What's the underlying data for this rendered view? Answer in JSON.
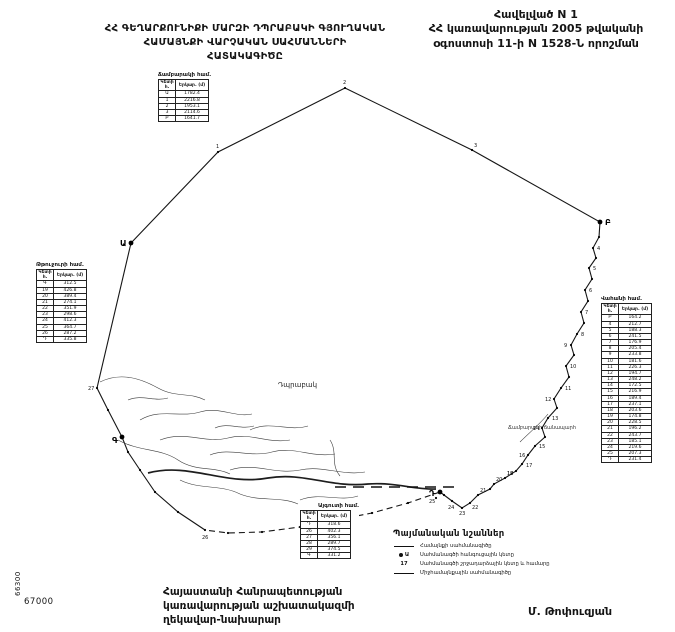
{
  "header": {
    "title_lines": [
      "ՀՀ ԳԵՂԱՐՔՈՒՆԻՔԻ ՄԱՐԶԻ ԴՊՐԱԲԱԿԻ ԳՅՈՒՂԱԿԱՆ",
      "ՀԱՄԱՅՆՔԻ ՎԱՐՉԱԿԱՆ  ՍԱՀՄԱՆՆԵՐԻ",
      "ՀԱՏԱԿԱԳԻԾԸ"
    ],
    "annex_lines": [
      "Հավելված N 1",
      "ՀՀ կառավարության 2005 թվականի",
      "օգոստոսի 11-ի N 1528-Ն որոշման"
    ]
  },
  "map": {
    "settlement_label": "Դպրաբակ",
    "road_label": "Ճամբարակի ճանապարհ",
    "grid_x_label": "67000",
    "grid_y_label": "66300",
    "points": [
      {
        "x": 131,
        "y": 243,
        "label": "Ա",
        "big": true,
        "dx": -11,
        "dy": 3
      },
      {
        "x": 600,
        "y": 222,
        "label": "Բ",
        "big": true,
        "dx": 5,
        "dy": 3
      },
      {
        "x": 122,
        "y": 437,
        "label": "Գ",
        "big": true,
        "dx": -10,
        "dy": 6
      },
      {
        "x": 440,
        "y": 492,
        "label": "Դ",
        "big": true,
        "dx": -11,
        "dy": 4
      },
      {
        "x": 218,
        "y": 152,
        "label": "1",
        "dx": -2,
        "dy": -4
      },
      {
        "x": 345,
        "y": 88,
        "label": "2",
        "dx": -2,
        "dy": -4
      },
      {
        "x": 472,
        "y": 150,
        "label": "3",
        "dx": 2,
        "dy": -3
      },
      {
        "x": 593,
        "y": 248,
        "label": "4",
        "dx": 4,
        "dy": 2
      },
      {
        "x": 589,
        "y": 268,
        "label": "5",
        "dx": 4,
        "dy": 2
      },
      {
        "x": 585,
        "y": 290,
        "label": "6",
        "dx": 4,
        "dy": 2
      },
      {
        "x": 581,
        "y": 312,
        "label": "7",
        "dx": 4,
        "dy": 2
      },
      {
        "x": 577,
        "y": 334,
        "label": "8",
        "dx": 4,
        "dy": 2
      },
      {
        "x": 571,
        "y": 345,
        "label": "9",
        "dx": -7,
        "dy": 2
      },
      {
        "x": 566,
        "y": 366,
        "label": "10",
        "dx": 4,
        "dy": 2
      },
      {
        "x": 561,
        "y": 388,
        "label": "11",
        "dx": 4,
        "dy": 2
      },
      {
        "x": 554,
        "y": 399,
        "label": "12",
        "dx": -9,
        "dy": 2
      },
      {
        "x": 548,
        "y": 418,
        "label": "13",
        "dx": 4,
        "dy": 2
      },
      {
        "x": 542,
        "y": 428,
        "label": "14",
        "dx": -9,
        "dy": 2
      },
      {
        "x": 535,
        "y": 446,
        "label": "15",
        "dx": 4,
        "dy": 2
      },
      {
        "x": 528,
        "y": 455,
        "label": "16",
        "dx": -9,
        "dy": 2
      },
      {
        "x": 522,
        "y": 464,
        "label": "17",
        "dx": 4,
        "dy": 3
      },
      {
        "x": 516,
        "y": 471,
        "label": "18",
        "dx": -9,
        "dy": 4
      },
      {
        "x": 505,
        "y": 478,
        "label": "19",
        "dx": 2,
        "dy": -3
      },
      {
        "x": 494,
        "y": 484,
        "label": "20",
        "dx": 2,
        "dy": -3
      },
      {
        "x": 478,
        "y": 495,
        "label": "21",
        "dx": 2,
        "dy": -3
      },
      {
        "x": 470,
        "y": 503,
        "label": "22",
        "dx": 2,
        "dy": 6
      },
      {
        "x": 462,
        "y": 508,
        "label": "23",
        "dx": -3,
        "dy": 7
      },
      {
        "x": 452,
        "y": 501,
        "label": "24",
        "dx": -4,
        "dy": 8
      },
      {
        "x": 436,
        "y": 498,
        "label": "25",
        "dx": -7,
        "dy": 5
      },
      {
        "x": 205,
        "y": 530,
        "label": "26",
        "dx": -3,
        "dy": 9
      },
      {
        "x": 97,
        "y": 388,
        "label": "27",
        "dx": -9,
        "dy": 2
      },
      {
        "x": 599,
        "y": 237
      },
      {
        "x": 596,
        "y": 258
      },
      {
        "x": 592,
        "y": 279
      },
      {
        "x": 588,
        "y": 301
      },
      {
        "x": 584,
        "y": 323
      },
      {
        "x": 574,
        "y": 355
      },
      {
        "x": 569,
        "y": 377
      },
      {
        "x": 557,
        "y": 408
      },
      {
        "x": 545,
        "y": 437
      },
      {
        "x": 490,
        "y": 489
      },
      {
        "x": 444,
        "y": 495
      },
      {
        "x": 408,
        "y": 503
      },
      {
        "x": 372,
        "y": 513
      },
      {
        "x": 336,
        "y": 520
      },
      {
        "x": 300,
        "y": 527
      },
      {
        "x": 262,
        "y": 532
      },
      {
        "x": 228,
        "y": 533
      },
      {
        "x": 178,
        "y": 512
      },
      {
        "x": 155,
        "y": 492
      },
      {
        "x": 140,
        "y": 470
      },
      {
        "x": 128,
        "y": 452
      },
      {
        "x": 108,
        "y": 410
      }
    ]
  },
  "tables": {
    "top": {
      "caption": "Ճամբարակի համ.",
      "headers": [
        "Կետի հ.",
        "Երկար. (մ)"
      ],
      "rows": [
        [
          "Ա",
          "1782.4"
        ],
        [
          "1",
          "2216.8"
        ],
        [
          "2",
          "1953.1"
        ],
        [
          "3",
          "2114.6"
        ],
        [
          "Բ",
          "1641.7"
        ]
      ]
    },
    "left": {
      "caption": "Թթուջուրի համ.",
      "headers": [
        "Կետի հ.",
        "Երկար. (մ)"
      ],
      "rows": [
        [
          "Գ",
          "312.5"
        ],
        [
          "19",
          "426.8"
        ],
        [
          "20",
          "389.4"
        ],
        [
          "21",
          "274.1"
        ],
        [
          "22",
          "351.9"
        ],
        [
          "23",
          "298.6"
        ],
        [
          "24",
          "412.3"
        ],
        [
          "25",
          "364.7"
        ],
        [
          "26",
          "287.2"
        ],
        [
          "Դ",
          "335.8"
        ]
      ]
    },
    "right": {
      "caption": "Վահանի համ.",
      "headers": [
        "Կետի հ.",
        "Երկար. (մ)"
      ],
      "rows": [
        [
          "Բ",
          "164.2"
        ],
        [
          "4",
          "212.7"
        ],
        [
          "5",
          "188.3"
        ],
        [
          "6",
          "241.5"
        ],
        [
          "7",
          "176.9"
        ],
        [
          "8",
          "205.4"
        ],
        [
          "9",
          "233.8"
        ],
        [
          "10",
          "181.6"
        ],
        [
          "11",
          "226.3"
        ],
        [
          "12",
          "194.7"
        ],
        [
          "13",
          "248.2"
        ],
        [
          "14",
          "172.5"
        ],
        [
          "15",
          "216.9"
        ],
        [
          "16",
          "189.4"
        ],
        [
          "17",
          "237.1"
        ],
        [
          "18",
          "203.6"
        ],
        [
          "19",
          "174.8"
        ],
        [
          "20",
          "228.5"
        ],
        [
          "21",
          "196.2"
        ],
        [
          "22",
          "243.7"
        ],
        [
          "23",
          "185.1"
        ],
        [
          "24",
          "219.6"
        ],
        [
          "25",
          "207.3"
        ],
        [
          "Դ",
          "231.4"
        ]
      ]
    },
    "bottom": {
      "caption": "Այգուտի համ.",
      "headers": [
        "Կետի հ.",
        "Երկար. (մ)"
      ],
      "rows": [
        [
          "Դ",
          "318.6"
        ],
        [
          "26",
          "402.3"
        ],
        [
          "27",
          "356.1"
        ],
        [
          "28",
          "289.7"
        ],
        [
          "29",
          "374.5"
        ],
        [
          "Գ",
          "331.2"
        ]
      ]
    }
  },
  "legend": {
    "title": "Պայմանական նշաններ",
    "items": [
      {
        "label": "Համայնքի սահմանագիծը"
      },
      {
        "symbol_text": "Ա",
        "label": "Սահմանագծի հանգուցային կետը"
      },
      {
        "symbol_text": "17",
        "label": "Սահմանագծի շրջադարձային կետը և համարը"
      },
      {
        "label": "Միջհամայնքային սահմանագիծը"
      }
    ]
  },
  "footer": {
    "gov_lines": [
      "Հայաստանի Հանրապետության",
      "կառավարության աշխատակազմի",
      "ղեկավար-նախարար"
    ],
    "signature": "Մ. Թոփուզյան"
  }
}
